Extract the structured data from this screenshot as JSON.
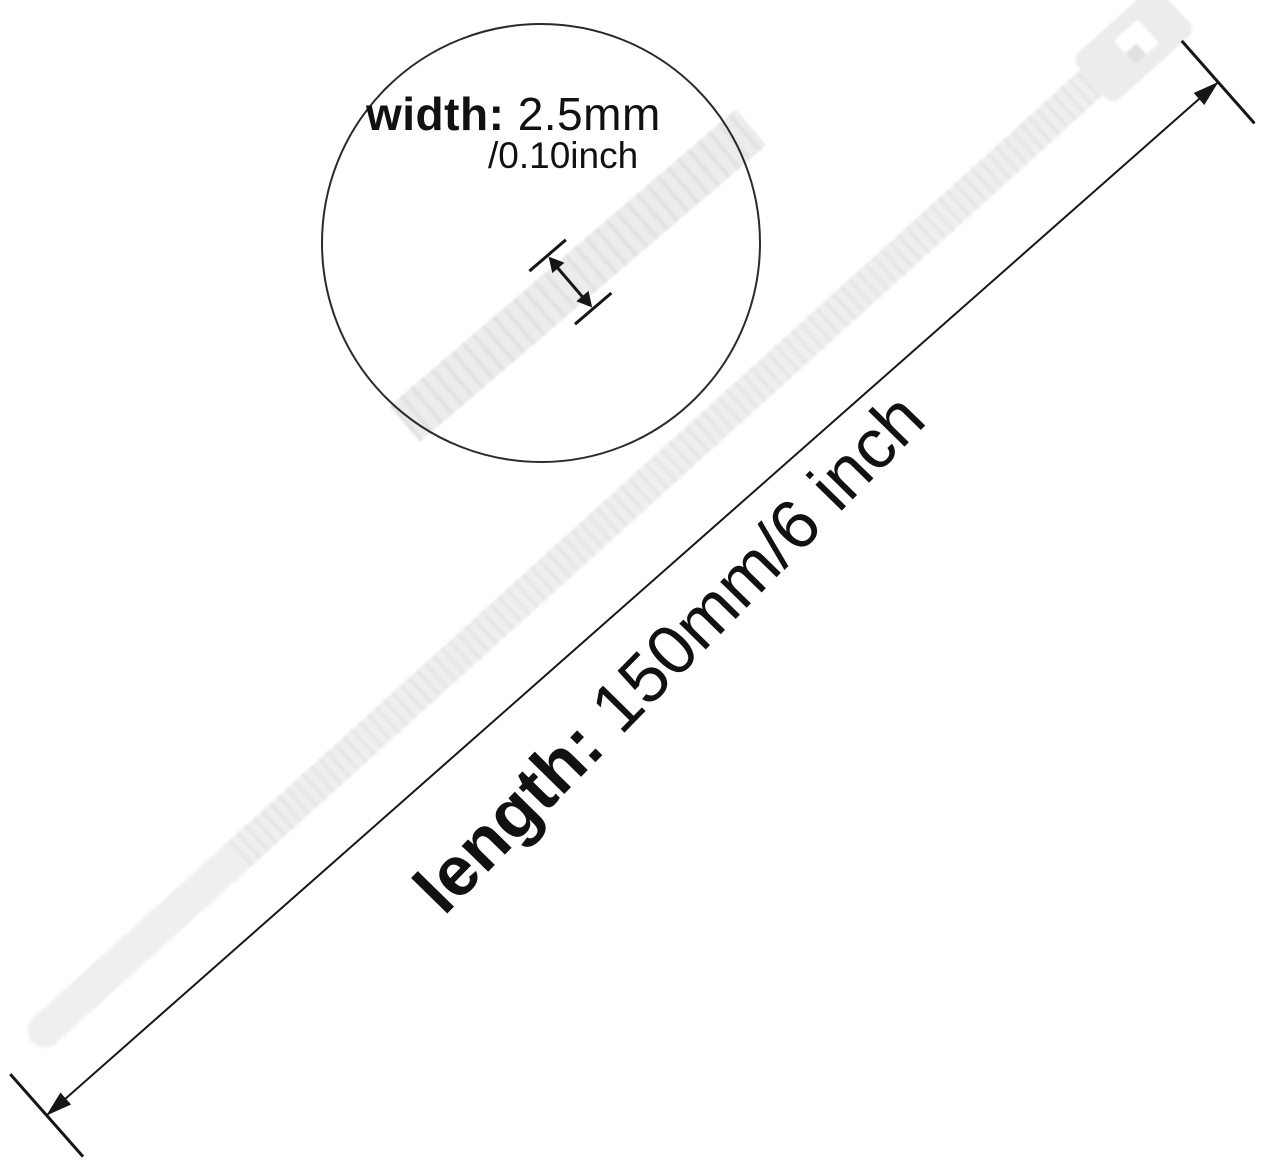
{
  "figure": {
    "type": "product-dimension-diagram",
    "subject": "white nylon cable zip tie"
  },
  "width_callout": {
    "label": "width:",
    "value": "2.5mm",
    "value_alt": "/0.10inch"
  },
  "length_dimension": {
    "label": "length:",
    "value": "150mm/6 inch"
  },
  "colors": {
    "background": "#ffffff",
    "tie_fill": "#efefef",
    "tie_rib": "#e3e3e3",
    "head_fill": "#ececec",
    "dimension_line": "#161616",
    "circle_outline": "#2b2b2b",
    "text": "#111111"
  }
}
